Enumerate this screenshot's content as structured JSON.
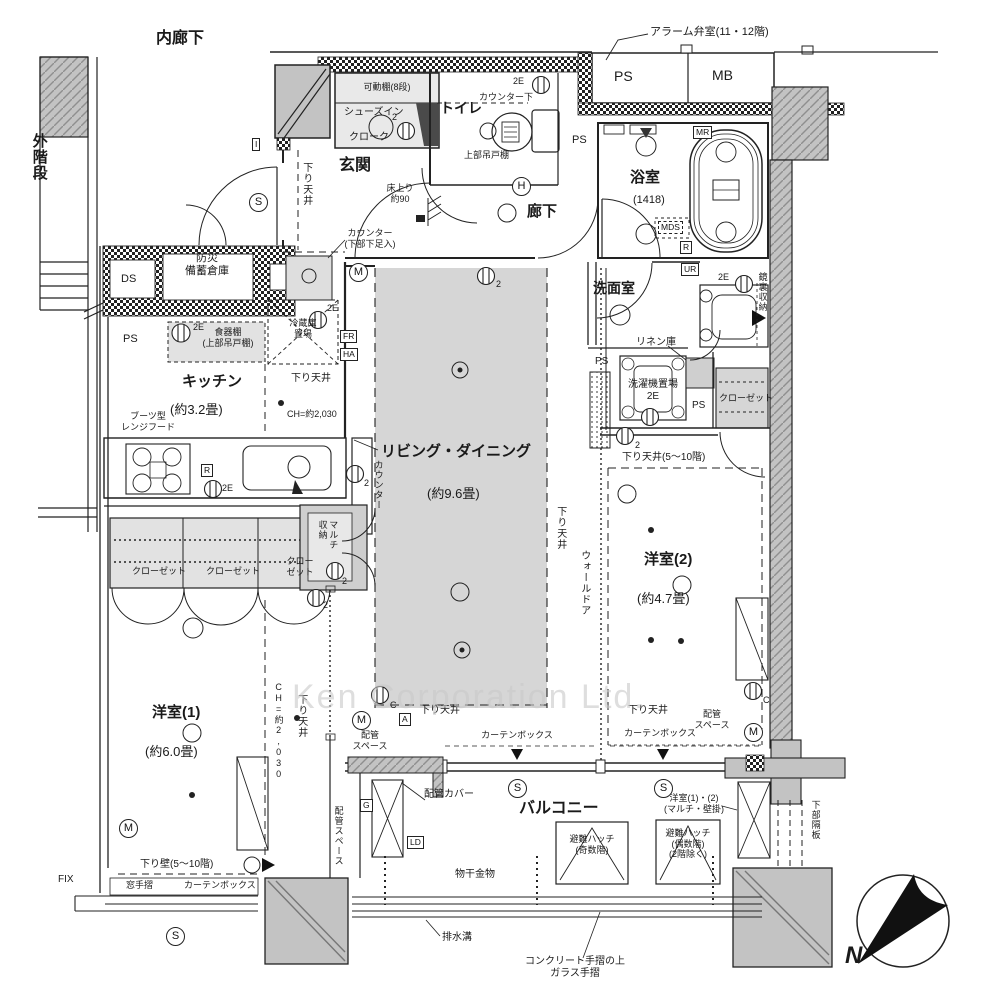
{
  "document": {
    "type": "apartment-floor-plan",
    "watermark": "Ken Corporation Ltd."
  },
  "labels": {
    "naka_rouka": "内廊下",
    "soto_kaidan": "外階段",
    "alarm_room": "アラーム弁室(11・12階)",
    "ps": "PS",
    "mb": "MB",
    "kadou_tana": "可動棚(8段)",
    "shoes_in": "シューズイン",
    "cloak": "クローク",
    "genkan": "玄関",
    "yuka_agari": "床上り\n約90",
    "sagari_tenjo": "下り天井",
    "counter_kabu": "カウンター\n(下部下足入)",
    "toilet": "トイレ",
    "counter_shita": "カウンター下",
    "joubu_tsuridana": "上部吊戸棚",
    "rouka": "廊下",
    "yokushitsu": "浴室",
    "yokushitsu_size": "(1418)",
    "senmen": "洗面室",
    "kagamiura": "鏡裏収納",
    "linen": "リネン庫",
    "sentakuki": "洗濯機置場\n2E",
    "closet": "クローゼット",
    "closet_wrap": "クロー\nゼット",
    "sagari_5_10": "下り天井(5〜10階)",
    "yoshitsu2": "洋室(2)",
    "yoshitsu2_size": "(約4.7畳)",
    "bousai": "防災\n備蓄倉庫",
    "ds": "DS",
    "shokkidana": "食器棚\n(上部吊戸棚)",
    "reizouko": "冷蔵庫\n置場",
    "kitchen": "キッチン",
    "kitchen_size": "(約3.2畳)",
    "ch2030": "CH=約2,030",
    "boots_hood": "ブーツ型\nレンジフード",
    "counter": "カウンター",
    "living": "リビング・ダイニング",
    "living_size": "(約9.6畳)",
    "wall_door": "ウォールドア",
    "multi_shunou": "マルチ\n収納",
    "yoshitsu1": "洋室(1)",
    "yoshitsu1_size": "(約6.0畳)",
    "haikan_space": "配管\nスペース",
    "haikan_space_v": "配管スペース",
    "curtain_box": "カーテンボックス",
    "balcony": "バルコニー",
    "haikan_cover": "配管カバー",
    "monohoshi": "物干金物",
    "hinan_odd": "避難ハッチ\n(奇数階)",
    "hinan_even": "避難ハッチ\n(偶数階)\n(2階除く)",
    "yoshitsu12": "洋室(1)・(2)\n(マルチ・壁掛)",
    "kabu_kakuban": "下部隔板",
    "haisui": "排水溝",
    "tesuri": "コンクリート手摺の上\nガラス手摺",
    "fix": "FIX",
    "sagari_kabe": "下り壁(5〜10階)",
    "mado_tesuri": "窓手摺",
    "north": "N"
  },
  "symbols": {
    "s": "S",
    "m": "M",
    "h": "H",
    "c": "C",
    "a": "A",
    "i": "I",
    "g": "G",
    "ld": "LD",
    "r": "R",
    "ur": "UR",
    "mr": "MR",
    "mds": "MDS",
    "fr": "FR",
    "ha": "HA",
    "e2": "2E",
    "n2": "2"
  },
  "colors": {
    "line": "#222222",
    "wall_fill": "#c3c3c3",
    "floor_shade": "#d6d6d6",
    "cabinet_fill": "#e2e2e2",
    "dark_wedge": "#4a4a4a",
    "watermark": "#c9c9c9",
    "compass_needle": "#111111"
  }
}
